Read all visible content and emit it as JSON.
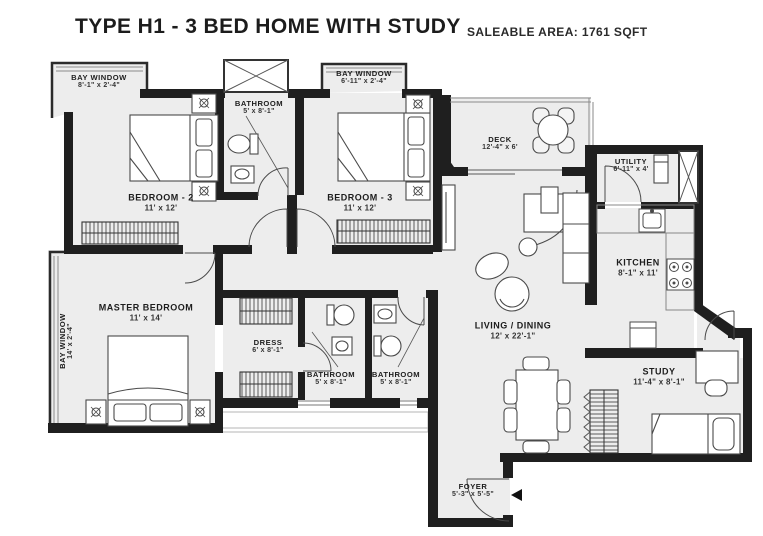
{
  "header": {
    "title": "TYPE H1 - 3 BED HOME WITH STUDY",
    "area_label": "SALEABLE AREA: 1761 SQFT"
  },
  "rooms": {
    "bay_window_1": {
      "name": "BAY WINDOW",
      "dims": "8'-1\" x 2'-4\""
    },
    "bay_window_2": {
      "name": "BAY WINDOW",
      "dims": "6'-11\" x 2'-4\""
    },
    "bay_window_master": {
      "name": "BAY WINDOW",
      "dims": "14' x 2'-4\""
    },
    "bedroom_2": {
      "name": "BEDROOM - 2",
      "dims": "11' x 12'"
    },
    "bedroom_3": {
      "name": "BEDROOM - 3",
      "dims": "11' x 12'"
    },
    "bathroom_1": {
      "name": "BATHROOM",
      "dims": "5' x 8'-1\""
    },
    "bathroom_2": {
      "name": "BATHROOM",
      "dims": "5' x 8'-1\""
    },
    "bathroom_3": {
      "name": "BATHROOM",
      "dims": "5' x 8'-1\""
    },
    "deck": {
      "name": "DECK",
      "dims": "12'-4\" x 6'"
    },
    "utility": {
      "name": "UTILITY",
      "dims": "6'-11\" x 4'"
    },
    "kitchen": {
      "name": "KITCHEN",
      "dims": "8'-1\" x 11'"
    },
    "living_dining": {
      "name": "LIVING / DINING",
      "dims": "12' x 22'-1\""
    },
    "master_bedroom": {
      "name": "MASTER BEDROOM",
      "dims": "11' x 14'"
    },
    "dress": {
      "name": "DRESS",
      "dims": "6' x 8'-1\""
    },
    "study": {
      "name": "STUDY",
      "dims": "11'-4\" x 8'-1\""
    },
    "foyer": {
      "name": "FOYER",
      "dims": "5'-3\" x 5'-5\""
    }
  },
  "colors": {
    "wall": "#1f1f1f",
    "floor": "#ededed",
    "thin_line": "#8a8a8a"
  }
}
